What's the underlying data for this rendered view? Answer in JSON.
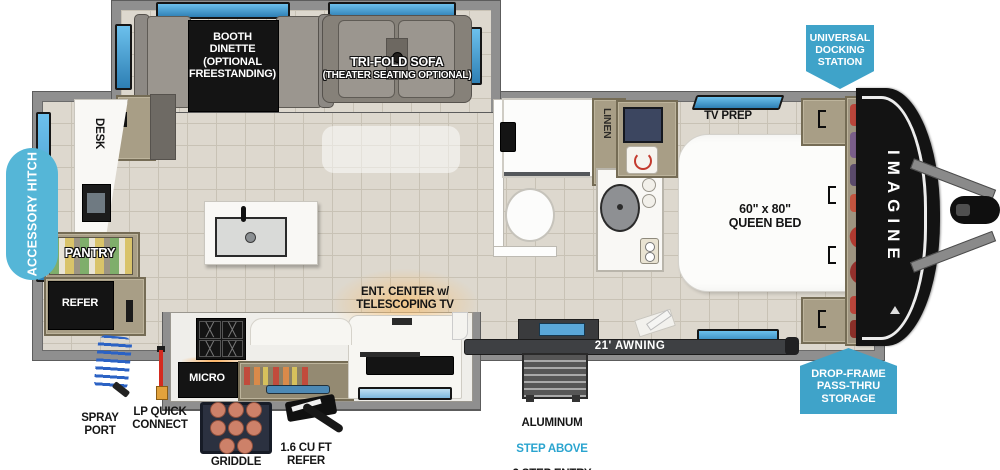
{
  "branding": {
    "model_name": "IMAGINE"
  },
  "colors": {
    "badge_blue": "#3fa3c9",
    "pill_blue": "#55b6d7",
    "accent_text_blue": "#2aa4cf",
    "window_blue": "#3e96c8",
    "wall_gray": "#8f8f8f",
    "floor_tile": "#ddd8ce",
    "cabinet_tan": "#a89e86"
  },
  "callouts": {
    "accessory_hitch": "ACCESSORY HITCH",
    "universal_docking_station": "UNIVERSAL\nDOCKING\nSTATION",
    "drop_frame_storage": "DROP-FRAME\nPASS-THRU\nSTORAGE",
    "awning": "21' AWNING",
    "spray_port": "SPRAY\nPORT",
    "lp_quick_connect": "LP QUICK\nCONNECT",
    "griddle": "GRIDDLE",
    "exterior_refer": "1.6 CU FT\nREFER",
    "entry_line1": "ALUMINUM",
    "entry_line2": "STEP ABOVE",
    "entry_line3": "3 STEP ENTRY"
  },
  "interior_labels": {
    "booth_dinette": "BOOTH\nDINETTE\n(OPTIONAL\nFREESTANDING)",
    "tri_fold_sofa_line1": "TRI-FOLD SOFA",
    "tri_fold_sofa_line2": "(THEATER SEATING OPTIONAL)",
    "desk": "DESK",
    "pantry": "PANTRY",
    "refer": "REFER",
    "micro": "MICRO",
    "linen": "LINEN",
    "tv_prep": "TV PREP",
    "queen_bed_size": "60\" x 80\"",
    "queen_bed_name": "QUEEN BED",
    "ent_center": "ENT. CENTER w/\nTELESCOPING TV"
  }
}
